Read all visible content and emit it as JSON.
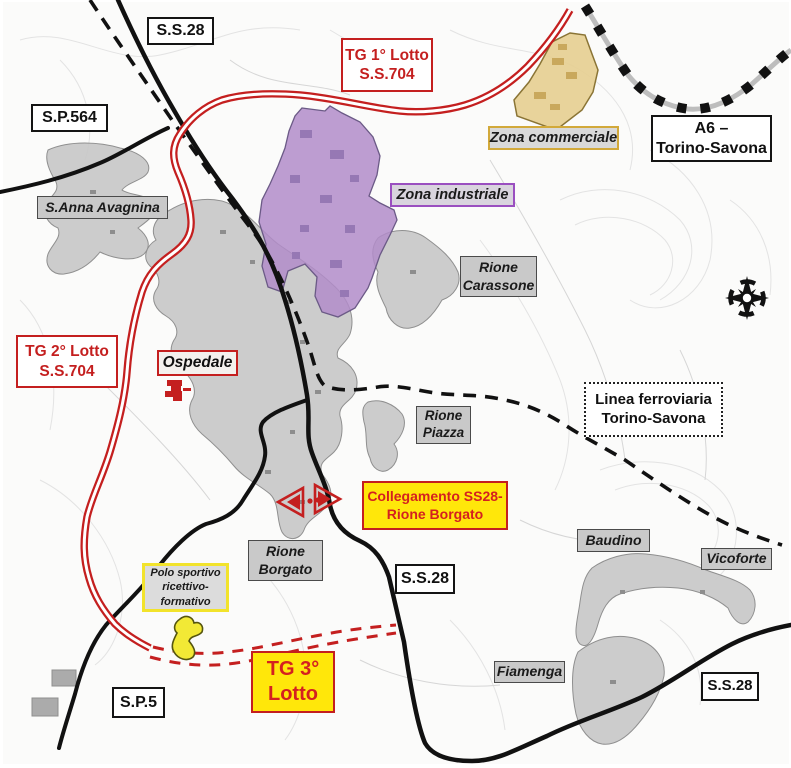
{
  "labels": {
    "ss28_top": "S.S.28",
    "tg1": {
      "line1": "TG 1° Lotto",
      "line2": "S.S.704"
    },
    "sp564": "S.P.564",
    "a6": {
      "line1": "A6 –",
      "line2": "Torino-Savona"
    },
    "zona_commerciale": "Zona commerciale",
    "zona_industriale": "Zona industriale",
    "s_anna": "S.Anna Avagnina",
    "rione_carassone": {
      "line1": "Rione",
      "line2": "Carassone"
    },
    "tg2": {
      "line1": "TG 2° Lotto",
      "line2": "S.S.704"
    },
    "ospedale": "Ospedale",
    "rione_piazza": {
      "line1": "Rione",
      "line2": "Piazza"
    },
    "linea_ferroviaria": {
      "line1": "Linea ferroviaria",
      "line2": "Torino-Savona"
    },
    "collegamento": {
      "line1": "Collegamento SS28-",
      "line2": "Rione Borgato"
    },
    "rione_borgato": {
      "line1": "Rione",
      "line2": "Borgato"
    },
    "ss28_mid": "S.S.28",
    "polo_sportivo": {
      "line1": "Polo sportivo",
      "line2": "ricettivo-",
      "line3": "formativo"
    },
    "tg3": {
      "line1": "TG 3°",
      "line2": "Lotto"
    },
    "sp5": "S.P.5",
    "baudino": "Baudino",
    "vicoforte": "Vicoforte",
    "fiamenga": "Fiamenga",
    "ss28_bottom": "S.S.28"
  },
  "icons": {
    "compass": "compass-rose-icon",
    "hospital": "hospital-icon",
    "connection_arrow": "connection-arrow-icon"
  },
  "colors": {
    "road_red": "#c41f1f",
    "highlight_yellow": "#ffe70a",
    "zone_industrial_fill": "#b18cc9",
    "zone_commercial_fill": "#e6cf92",
    "urban_gray": "#c4c4c4",
    "railway_black": "#111111"
  }
}
